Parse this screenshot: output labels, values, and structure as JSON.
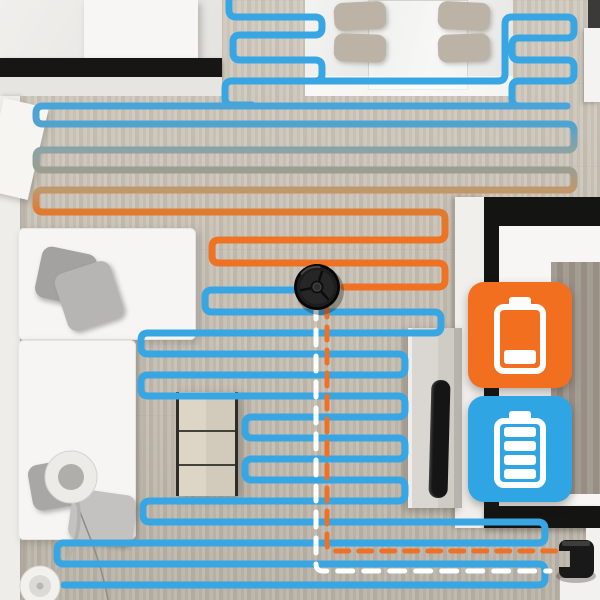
{
  "scene": "robot-vacuum-recharge-and-resume-cleaning-path",
  "robot": {
    "name": "robot-vacuum",
    "color": "#1d1d1d",
    "position": {
      "x": 317,
      "y": 287
    }
  },
  "dock": {
    "name": "charging-dock",
    "color": "#191919",
    "position": {
      "x": 574,
      "y": 558
    }
  },
  "battery_indicators": [
    {
      "id": "battery-low",
      "state": "low",
      "bars": 1,
      "bars_total": 4,
      "color": "#F36F20",
      "icon": "battery-low-icon"
    },
    {
      "id": "battery-full",
      "state": "full",
      "bars": 4,
      "bars_total": 4,
      "color": "#2FA5E4",
      "icon": "battery-full-icon"
    }
  ],
  "cleaning_paths": {
    "full_battery_color": "#38A6E2",
    "low_battery_color": "#EF7123",
    "depleting_gradient": [
      "#46A5DC",
      "#8CA3A6",
      "#9C9E90",
      "#C2986A",
      "#DE7B30",
      "#EF7123"
    ],
    "return_to_dock": {
      "style": "dashed",
      "color": "#ED7227"
    },
    "resume_path": {
      "style": "dashed",
      "color": "#FFFFFF"
    }
  },
  "room": {
    "floor": {
      "type": "wood-planks",
      "color": "#c9c2b7"
    },
    "furniture": [
      "sofa",
      "pillows",
      "floor-lamp",
      "side-table",
      "coffee-table",
      "tv-console",
      "tv",
      "dining-table",
      "dining-chairs",
      "kitchen-counter",
      "glass-partition",
      "charging-dock"
    ]
  }
}
